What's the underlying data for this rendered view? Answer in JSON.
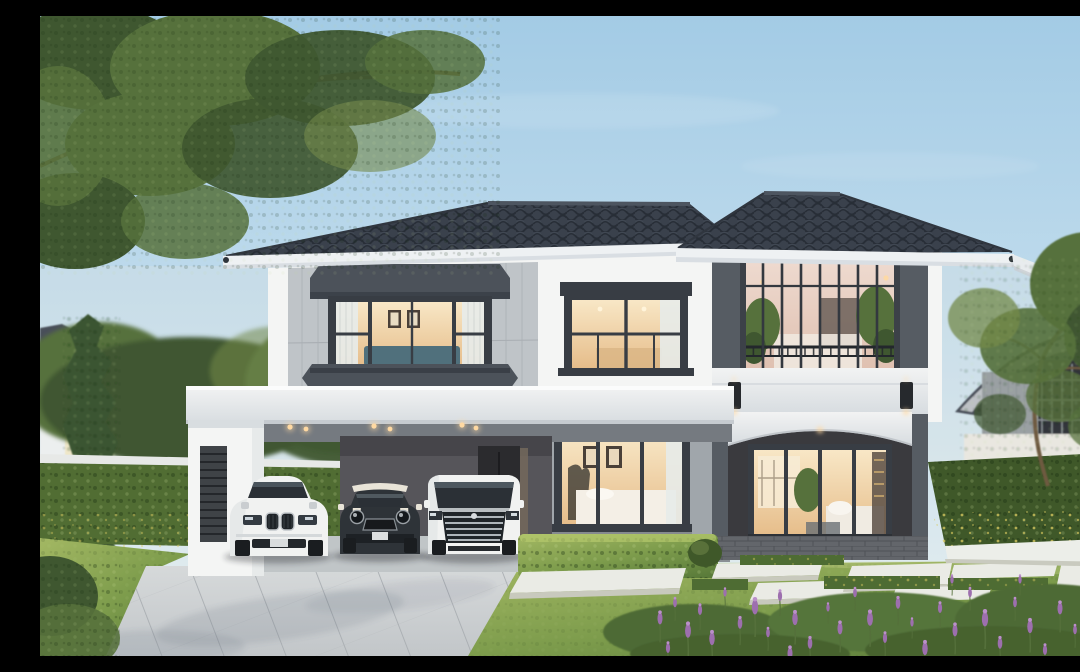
{
  "meta": {
    "type": "architectural-exterior-render",
    "time_of_day": "dusk",
    "description": "Photoreal rendering of a modern two-storey hip-roof house at dusk with warm interior lights, a white flat-roof carport sheltering three cars (white SUV, black mini hatchback, white luxury van), trimmed hedges, lawn with stepping stones and lavender in the foreground"
  },
  "scene": {
    "objects": [
      "sky",
      "overhanging-tree-branch",
      "neighbor-house-left",
      "neighbor-house-right",
      "tall-cypress-tree",
      "background-trees",
      "hedge-fence-left",
      "hedge-fence-right",
      "main-house",
      "hip-roof-dark-tiles",
      "bay-window-upper-left",
      "upper-middle-window",
      "glass-balcony-tower",
      "balcony-plants",
      "wall-sconces",
      "arched-porch",
      "living-room-glass-doors",
      "bedroom-window-ground-floor",
      "carport",
      "carport-downlights",
      "louver-vent-panel",
      "white-suv",
      "black-mini-hatchback",
      "white-luxury-van",
      "paved-driveway",
      "lawn",
      "trimmed-hedge-boxes",
      "stepping-stones",
      "lavender-bushes",
      "white-garden-curb"
    ],
    "cars": [
      {
        "label": "white luxury SUV with twin kidney grille"
      },
      {
        "label": "black mini hatchback with white roof and bonnet stripes"
      },
      {
        "label": "white luxury MPV van with large chrome grille"
      }
    ],
    "lighting": [
      "warm recessed carport downlights",
      "warm window glow on both floors",
      "porch downlight",
      "two wall sconces on tower columns"
    ]
  },
  "colors": {
    "sky_top": "#a3cbe5",
    "sky_mid": "#c6dfee",
    "sky_low": "#e9efee",
    "horizon_warm": "#f2e8d8",
    "foliage_dark": "#3f5730",
    "foliage_mid": "#56713c",
    "foliage_light": "#73894b",
    "branch": "#6e5a41",
    "cypress": "#3a5430",
    "hedge_dark": "#3f5829",
    "hedge_mid": "#516d33",
    "hedge_cap": "#e7e9e7",
    "hedge_flower": "#d9c95f",
    "roof_base": "#3a414c",
    "roof_groove": "#262c35",
    "roof_ridge": "#4d5560",
    "fascia": "#eef1f3",
    "soffit": "#d9dee3",
    "wall_white": "#f4f5f4",
    "wall_white_shade": "#e7eaea",
    "wall_panel": "#bfc4c8",
    "panel_seam": "#a9aeb3",
    "wall_dark_accent": "#4c525a",
    "frame_dark": "#383d44",
    "glass_warm_hi": "#f8e7c6",
    "glass_warm_lo": "#e6bd8a",
    "glass_pink_hi": "#f0ddd3",
    "glass_pink_lo": "#dfc0b0",
    "curtain": "#e7ebe9",
    "interior_teal": "#50707c",
    "picture_frame": "#4a4038",
    "band_white": "#f2f3f3",
    "band_shade": "#d7dce0",
    "wall_gray": "#a0a6ab",
    "wall_gray_dark": "#56555a",
    "door_dark": "#2b2b2e",
    "brick": "#63666b",
    "brick_joint": "#4f5257",
    "col_dark": "#565c63",
    "col_darker": "#44494f",
    "sconce": "#26292d",
    "warm_light": "#ffd9a2",
    "ceiling_gray": "#757a80",
    "louver": "#3f4347",
    "drive_hi": "#d6d9da",
    "drive_lo": "#c2c6c9",
    "drive_joint": "#a7acb0",
    "floor_gray": "#c0c5c7",
    "grass_hi": "#a3b863",
    "grass_mid": "#7d9c4c",
    "grass_dark": "#5a7b3a",
    "stone_hi": "#eaebe5",
    "stone_side": "#c8c9bd",
    "moss": "#4e6c33",
    "lavender": "#9d6fae",
    "lavender_hi": "#bb8fca",
    "lavender_stem": "#55703b",
    "car_white": "#f1f2f1",
    "car_white_shade": "#c9cdd0",
    "car_glass": "#2b3036",
    "car_dark": "#2e3338",
    "car_trim": "#c2c7cb",
    "tire": "#1a1d20",
    "neighbor_wall": "#9aa0a3",
    "neighbor_white": "#ecefef",
    "neighbor_band": "#e9e7e0",
    "neighbor_roof": "#4a505a",
    "neighbor_cream": "#efe7c8"
  }
}
